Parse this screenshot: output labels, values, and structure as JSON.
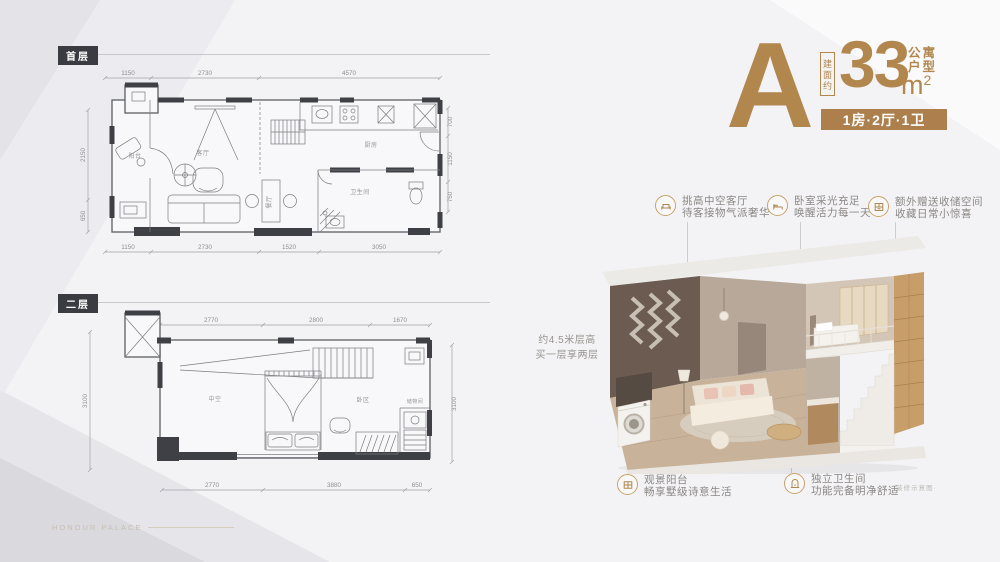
{
  "watermark": "HONOUR PALACE",
  "unit": {
    "letter": "A",
    "area_prefix": "建面约",
    "area_value": "33",
    "area_unit": "m",
    "area_sup": "2",
    "type_top": "公寓",
    "type_bottom": "户型",
    "badge": "1房·2厅·1卫"
  },
  "loft_note": {
    "line1": "约4.5米层高",
    "line2": "买一层享两层"
  },
  "plans": [
    {
      "label": "首层",
      "rooms": {
        "balcony": "阳台",
        "living": "客厅",
        "dining": "餐厅",
        "kitchen": "厨房",
        "bath": "卫生间"
      },
      "dims": {
        "top": [
          "1150",
          "2730",
          "4570"
        ],
        "bottom": [
          "1150",
          "2730",
          "1520",
          "3050"
        ],
        "left": [
          "2150",
          "650"
        ],
        "right": [
          "700",
          "1150",
          "750"
        ]
      }
    },
    {
      "label": "二层",
      "rooms": {
        "void": "中空",
        "sleep": "卧区",
        "storage": "储物间"
      },
      "dims": {
        "top": [
          "2770",
          "2800",
          "1670"
        ],
        "bottom": [
          "2770",
          "3880",
          "650"
        ],
        "left": [
          "3100"
        ],
        "right": [
          "3100"
        ]
      }
    }
  ],
  "callouts_top": [
    {
      "line1": "挑高中空客厅",
      "line2": "待客接物气派奢华"
    },
    {
      "line1": "卧室采光充足",
      "line2": "唤醒活力每一天"
    },
    {
      "line1": "额外赠送收储空间",
      "line2": "收藏日常小惊喜"
    }
  ],
  "callouts_bottom": [
    {
      "line1": "观景阳台",
      "line2": "畅享墅级诗意生活"
    },
    {
      "line1": "独立卫生间",
      "line2": "功能完备明净舒适"
    }
  ],
  "render_caption": "·装修示意图·",
  "colors": {
    "accent": "#b2874e",
    "badge_bg": "#ac7f4d",
    "wall_dark": "#3f4045",
    "text_gray": "#8b8885"
  }
}
